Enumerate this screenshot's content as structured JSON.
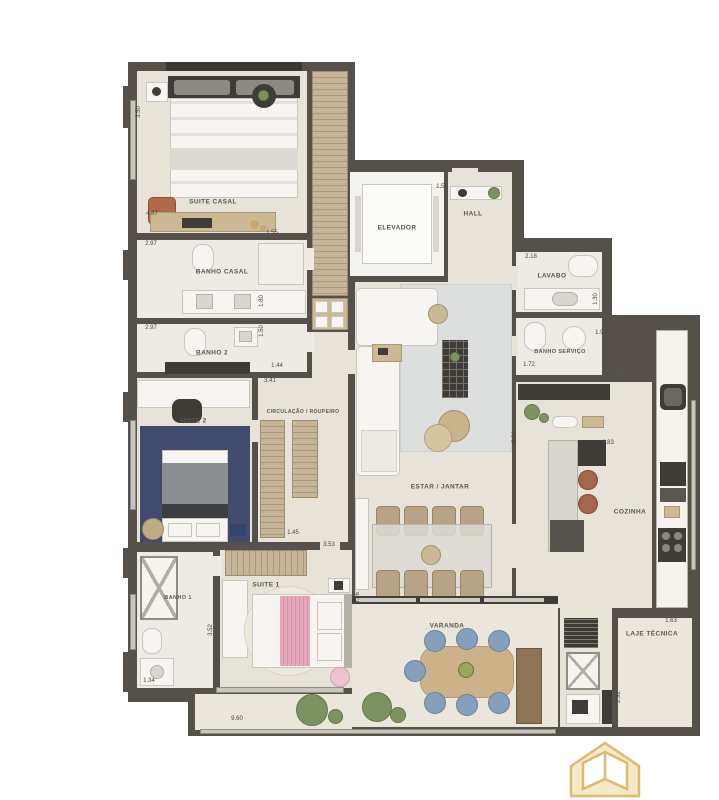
{
  "plan_type": "apartment-floor-plan",
  "colors": {
    "background": "#ffffff",
    "wall": "#55514a",
    "floor": "#e7e3d9",
    "wardrobe_tan": "#c6b597",
    "suite2_rug_blue": "#424b6e",
    "living_rug_gray": "#dddfde",
    "suite1_pink": "#e5a9bd",
    "varanda_chair_blue": "#86a0bb",
    "logo_gold": "#ddba6f"
  },
  "rooms": [
    {
      "name": "suite-casal",
      "label": "SUITE CASAL",
      "lx": 213,
      "ly": 202
    },
    {
      "name": "banho-casal",
      "label": "BANHO CASAL",
      "lx": 222,
      "ly": 272
    },
    {
      "name": "banho-2",
      "label": "BANHO 2",
      "lx": 212,
      "ly": 353
    },
    {
      "name": "suite-2",
      "label": "SUITE 2",
      "lx": 193,
      "ly": 421
    },
    {
      "name": "circulacao-roupeiro",
      "label": "CIRCULAÇÃO / ROUPEIRO",
      "lx": 303,
      "ly": 412,
      "size": 5
    },
    {
      "name": "banho-1",
      "label": "BANHO 1",
      "lx": 178,
      "ly": 598,
      "size": 5.5
    },
    {
      "name": "suite-1",
      "label": "SUITE 1",
      "lx": 266,
      "ly": 585
    },
    {
      "name": "elevador",
      "label": "ELEVADOR",
      "lx": 397,
      "ly": 228
    },
    {
      "name": "hall",
      "label": "HALL",
      "lx": 473,
      "ly": 214
    },
    {
      "name": "lavabo",
      "label": "LAVABO",
      "lx": 552,
      "ly": 276
    },
    {
      "name": "banho-servico",
      "label": "BANHO SERVIÇO",
      "lx": 560,
      "ly": 352,
      "size": 5.5
    },
    {
      "name": "servico",
      "label": "SERVIÇO",
      "lx": 628,
      "ly": 374
    },
    {
      "name": "cozinha",
      "label": "COZINHA",
      "lx": 630,
      "ly": 512
    },
    {
      "name": "estar-jantar",
      "label": "ESTAR / JANTAR",
      "lx": 440,
      "ly": 487
    },
    {
      "name": "varanda",
      "label": "VARANDA",
      "lx": 447,
      "ly": 626
    },
    {
      "name": "laje-tecnica",
      "label": "LAJE TÉCNICA",
      "lx": 652,
      "ly": 634
    }
  ],
  "dimensions": [
    {
      "value": "3.50",
      "x": 139,
      "y": 112,
      "rot": 1
    },
    {
      "value": "4.87",
      "x": 152,
      "y": 214
    },
    {
      "value": "1.55",
      "x": 272,
      "y": 233
    },
    {
      "value": "2.97",
      "x": 151,
      "y": 244
    },
    {
      "value": "1.80",
      "x": 262,
      "y": 301,
      "rot": 1
    },
    {
      "value": "2.97",
      "x": 151,
      "y": 328
    },
    {
      "value": "1.50",
      "x": 262,
      "y": 331,
      "rot": 1
    },
    {
      "value": "1.44",
      "x": 277,
      "y": 366
    },
    {
      "value": "3.41",
      "x": 270,
      "y": 381
    },
    {
      "value": "1.45",
      "x": 293,
      "y": 533
    },
    {
      "value": "3.53",
      "x": 329,
      "y": 545
    },
    {
      "value": "3.52",
      "x": 211,
      "y": 630,
      "rot": 1
    },
    {
      "value": "1.34",
      "x": 149,
      "y": 681
    },
    {
      "value": "9.60",
      "x": 237,
      "y": 719
    },
    {
      "value": "5.36",
      "x": 358,
      "y": 598,
      "rot": 1
    },
    {
      "value": "1.50",
      "x": 442,
      "y": 187
    },
    {
      "value": "2.18",
      "x": 531,
      "y": 257
    },
    {
      "value": "1.30",
      "x": 596,
      "y": 299,
      "rot": 1
    },
    {
      "value": "1.72",
      "x": 529,
      "y": 365
    },
    {
      "value": "1.93",
      "x": 601,
      "y": 333
    },
    {
      "value": "3.94",
      "x": 515,
      "y": 437,
      "rot": 1
    },
    {
      "value": "1.83",
      "x": 608,
      "y": 443
    },
    {
      "value": "1.63",
      "x": 671,
      "y": 621
    },
    {
      "value": "2.92",
      "x": 619,
      "y": 697,
      "rot": 1
    }
  ],
  "logo": {
    "name": "developer-logo",
    "shape": "gold-house-with-open-book"
  }
}
